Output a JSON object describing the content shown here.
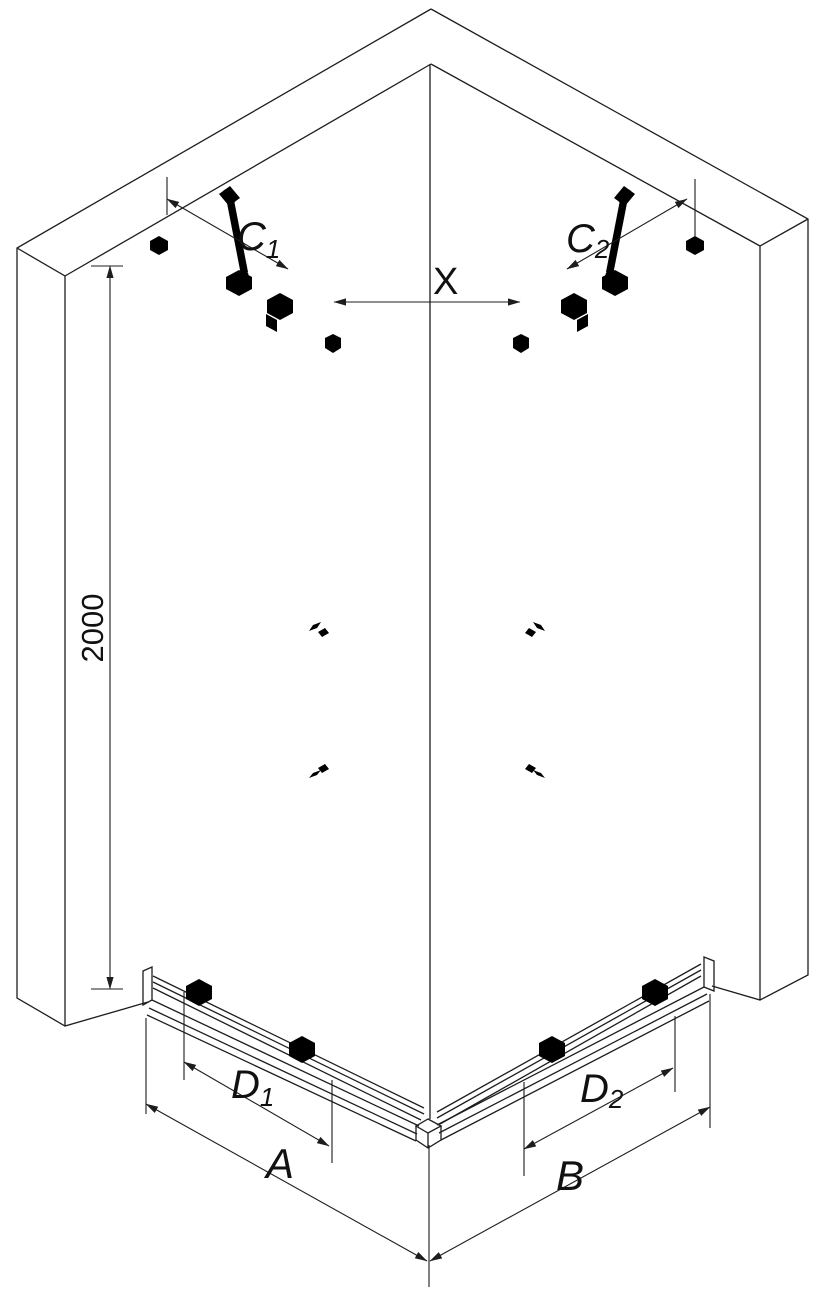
{
  "diagram": {
    "background_color": "#ffffff",
    "line_color": "#1d1d1d",
    "dimensions": {
      "height": "2000",
      "c1": {
        "base": "C",
        "sub": "1"
      },
      "c2": {
        "base": "C",
        "sub": "2"
      },
      "x": "X",
      "d1": {
        "base": "D",
        "sub": "1"
      },
      "d2": {
        "base": "D",
        "sub": "2"
      },
      "a": "A",
      "b": "B"
    }
  }
}
